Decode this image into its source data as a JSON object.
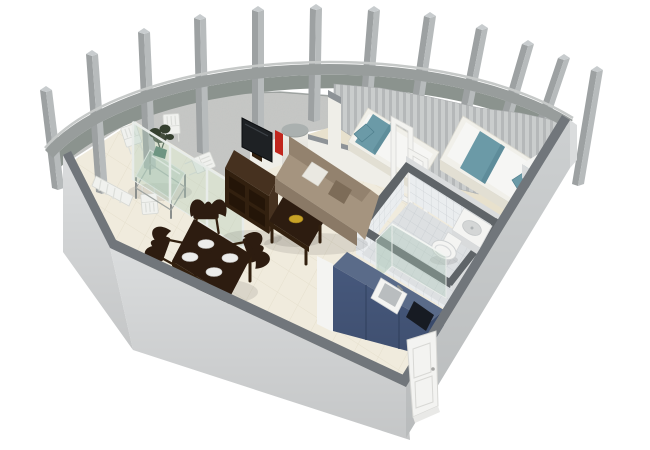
{
  "meta": {
    "description": "3D isometric floor plan rendering of a studio apartment with a curved colonnade balcony, living-dining room, bedroom, bathroom and kitchen",
    "view": "isometric cutaway, white background",
    "visible_text": []
  },
  "scene": {
    "structure": [
      "curved-parapet-wall",
      "colonnade-pillars (12)",
      "curtain-wall",
      "left-exterior-wall",
      "front-exterior-wall",
      "right-exterior-wall",
      "glass-partition",
      "bedroom-partition-wall",
      "round-column",
      "entrance-door"
    ],
    "rooms": [
      {
        "name": "balcony-terrace",
        "floor": "speckled gray stone",
        "furniture": [
          "glass-dining-table",
          "potted-plant",
          "white-slat-chair x4",
          "white-slat-bench"
        ]
      },
      {
        "name": "living-dining-room",
        "floor": "cream tile",
        "furniture": [
          "tv-cabinet",
          "flat-tv",
          "red-speaker",
          "sofa",
          "white-pillow",
          "coffee-table",
          "gold-bowl",
          "dining-table",
          "dining-chair x4",
          "plate x4"
        ]
      },
      {
        "name": "bedroom",
        "floor": "beige carpet",
        "furniture": [
          "double-bed",
          "single-bed",
          "teal-bedding",
          "nightstand",
          "open-white-door-frames",
          "curtains"
        ]
      },
      {
        "name": "bathroom",
        "floor": "white tile",
        "furniture": [
          "shower-tray",
          "toilet",
          "glass-shower-screen",
          "tiled-walls"
        ]
      },
      {
        "name": "kitchen",
        "furniture": [
          "blue-cabinet-unit",
          "sink",
          "black-cooktop",
          "tiled-backsplash"
        ]
      },
      {
        "name": "entrance",
        "furniture": [
          "white-paneled-front-door"
        ]
      }
    ]
  },
  "colors": {
    "bg": "#ffffff",
    "wall_top": "#71767b",
    "wall_face": "#dadcdd",
    "wall_face_dark": "#cdd0d1",
    "curve_band": "#989d9c",
    "curve_rim": "#c6c9c8",
    "curve_inner": "#8b938e",
    "pillar_light": "#b7bbbc",
    "pillar_dark": "#9da1a2",
    "pillar_cap": "#c8ccce",
    "curtain_a": "#cacdcd",
    "curtain_b": "#b5b8b9",
    "balcony_floor": "#c7c8c6",
    "main_floor": "#f0ebdd",
    "tile_line": "#e3ddca",
    "bedroom_floor": "#e8e1cd",
    "partition": "#efeee8",
    "partition_top": "#8e9397",
    "glass": "#aecaba",
    "glass_frame": "#e8ece9",
    "sofa_main": "#a5947f",
    "sofa_dark": "#93826e",
    "sofa_front": "#8a7966",
    "pillow_white": "#eae8e1",
    "cushion_dark": "#7d6c58",
    "wood": "#46311f",
    "wood_dark": "#32200f",
    "wood_hole": "#241508",
    "tv_screen": "#1e2124",
    "red_accent": "#c1261d",
    "gold": "#c8a226",
    "table_dark": "#2d1c10",
    "plate": "#ececea",
    "duvet": "#f6f6f4",
    "teal": "#6b9aa7",
    "teal_dark": "#54828f",
    "bed_frame": "#f1f0ea",
    "bed_side": "#e2dfd3",
    "white_fixture": "#f4f4f2",
    "fixture_shade": "#d9dbdc",
    "tile_wall": "#eaedef",
    "tile_grout": "#c9ced2",
    "bath_floor": "#dde0e2",
    "bath_wall_top": "#5f6468",
    "kitchen_top": "#5a6b89",
    "kitchen_front": "#46587c",
    "kitchen_line": "#394a6b",
    "cooktop": "#171b23",
    "sink_basin": "#b9bdbf",
    "door_white": "#f3f3f1",
    "door_shade": "#d8d8d5",
    "metal": "#8b8f8d",
    "plant_dark": "#35402f",
    "plant_pot": "#4e7a66",
    "column_cap": "#9aa09f"
  }
}
